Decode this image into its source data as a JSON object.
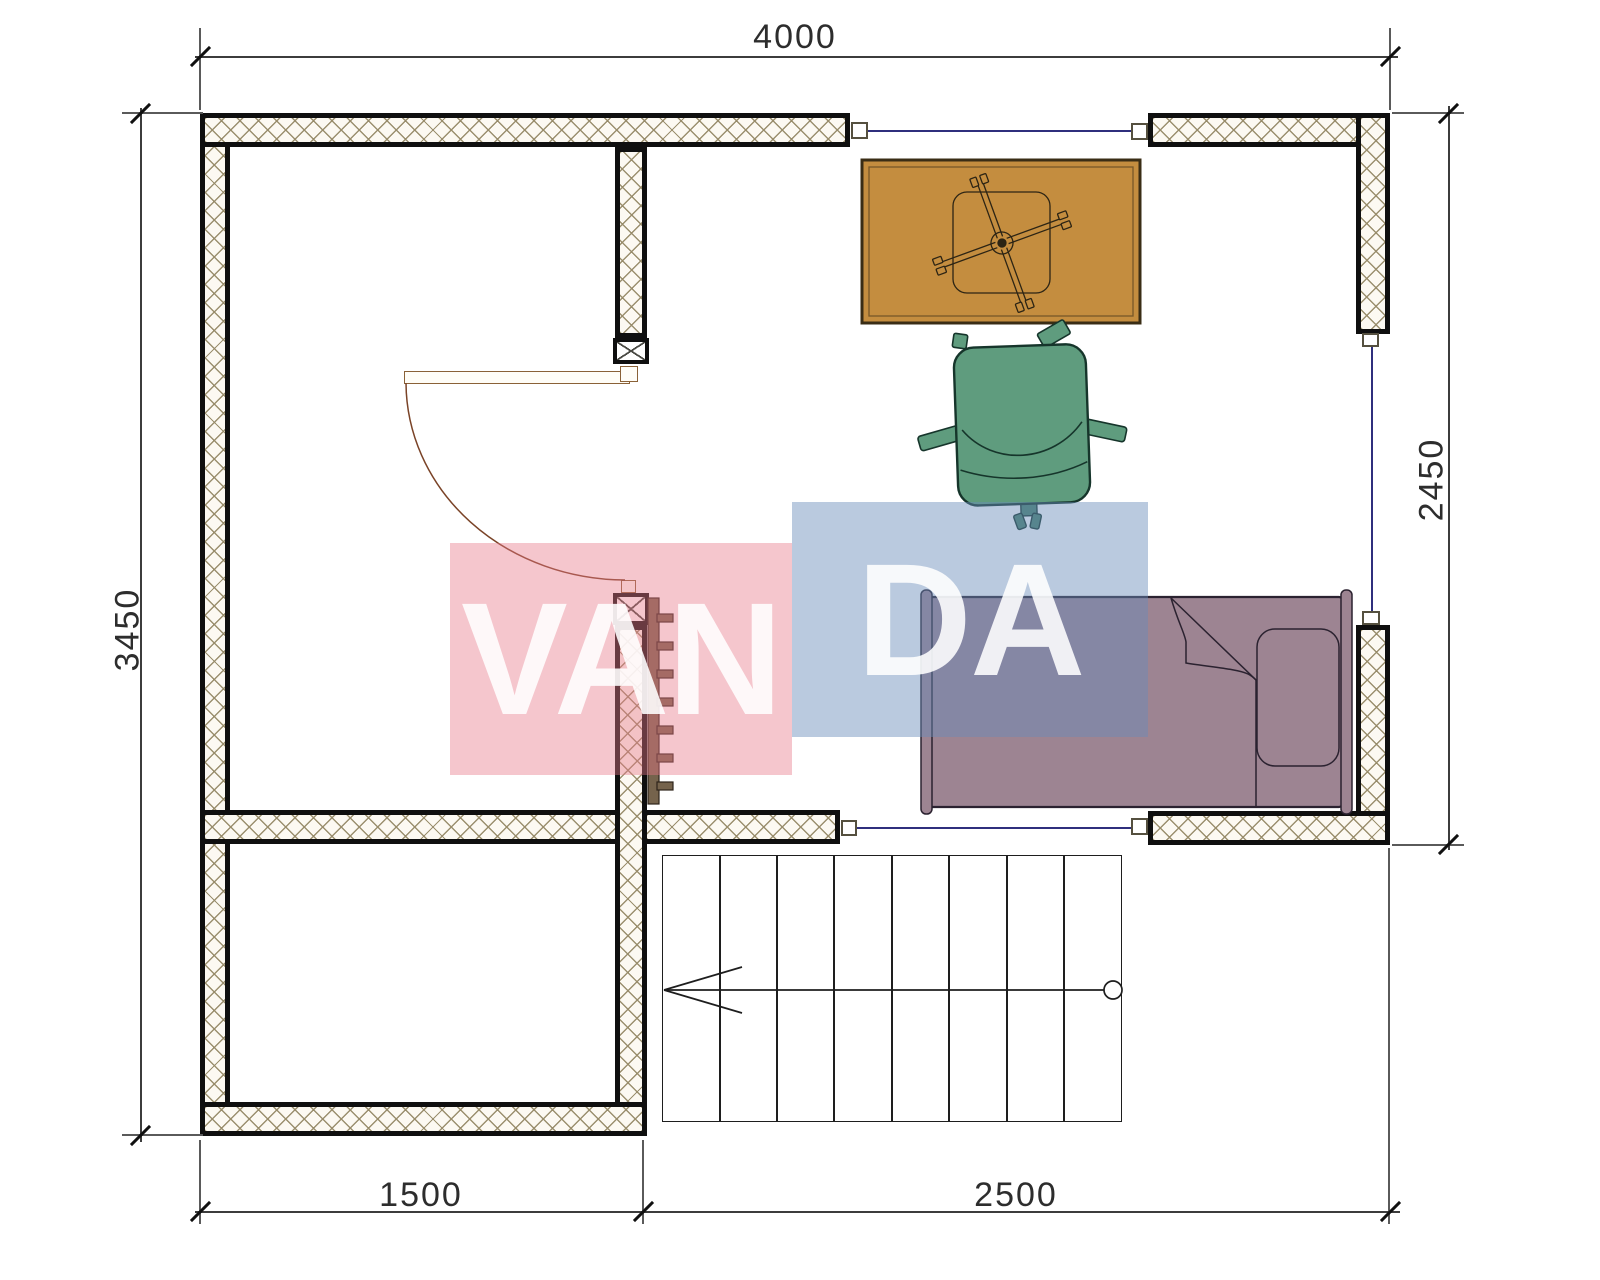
{
  "title": "Upper floor plan",
  "dimensions": {
    "top": "4000",
    "left": "3450",
    "right": "2450",
    "bottom_left": "1500",
    "bottom_right": "2500"
  },
  "watermark": {
    "text_left": "VAN",
    "text_right": "DA",
    "pink_hex": "#f6c9cf",
    "blue_hex": "#c5d3e3"
  },
  "furniture": {
    "desk": "desk",
    "chair": "office chair",
    "bed": "single bed",
    "radiator": "radiator"
  },
  "stairs": {
    "treads": 8,
    "direction": "left"
  },
  "colors": {
    "desk": "#c48d3f",
    "chair": "#5f9c7e",
    "bed": "#9d8492",
    "wall_hatch": "#968a68",
    "window_line": "#2f2f7d",
    "outline": "#0f0f0f"
  }
}
